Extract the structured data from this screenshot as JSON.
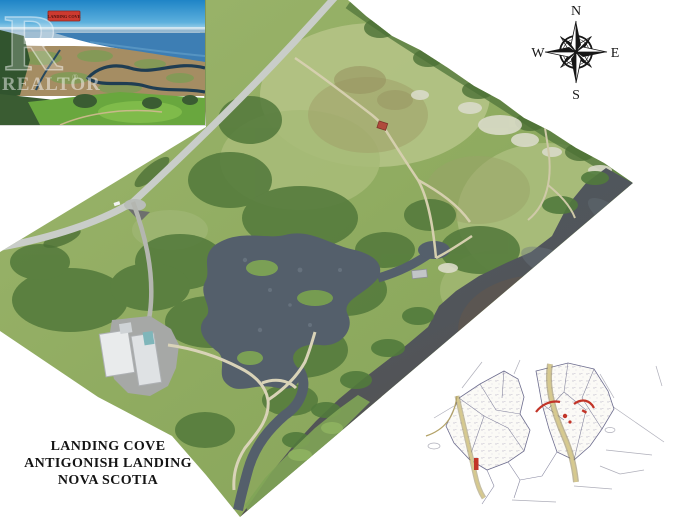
{
  "title_block": {
    "line1": "LANDING COVE",
    "line2": "ANTIGONISH LANDING",
    "line3": "NOVA SCOTIA"
  },
  "compass": {
    "north": "N",
    "east": "E",
    "south": "S",
    "west": "W"
  },
  "inset_photo": {
    "badge_label": "LANDING COVE",
    "watermark_big_letter": "R",
    "watermark_text": "REALTOR",
    "registered_symbol": "®"
  },
  "colors": {
    "background": "#ffffff",
    "badge_red": "#cc3a30",
    "plan_red_accent": "#c23428",
    "title_text": "#141414",
    "field_green": "#9db46d",
    "forest_green": "#567e3e",
    "pond_water": "#545f6b",
    "estuary_dark": "#4e5963",
    "estuary_brown": "#5a5048",
    "road_gray": "#c9cdc9",
    "trail_tan": "#d6d0b4",
    "sky_blue": "#2b8ccb",
    "plan_line": "#6c6c8e",
    "plan_road_tan": "#b3a267"
  }
}
